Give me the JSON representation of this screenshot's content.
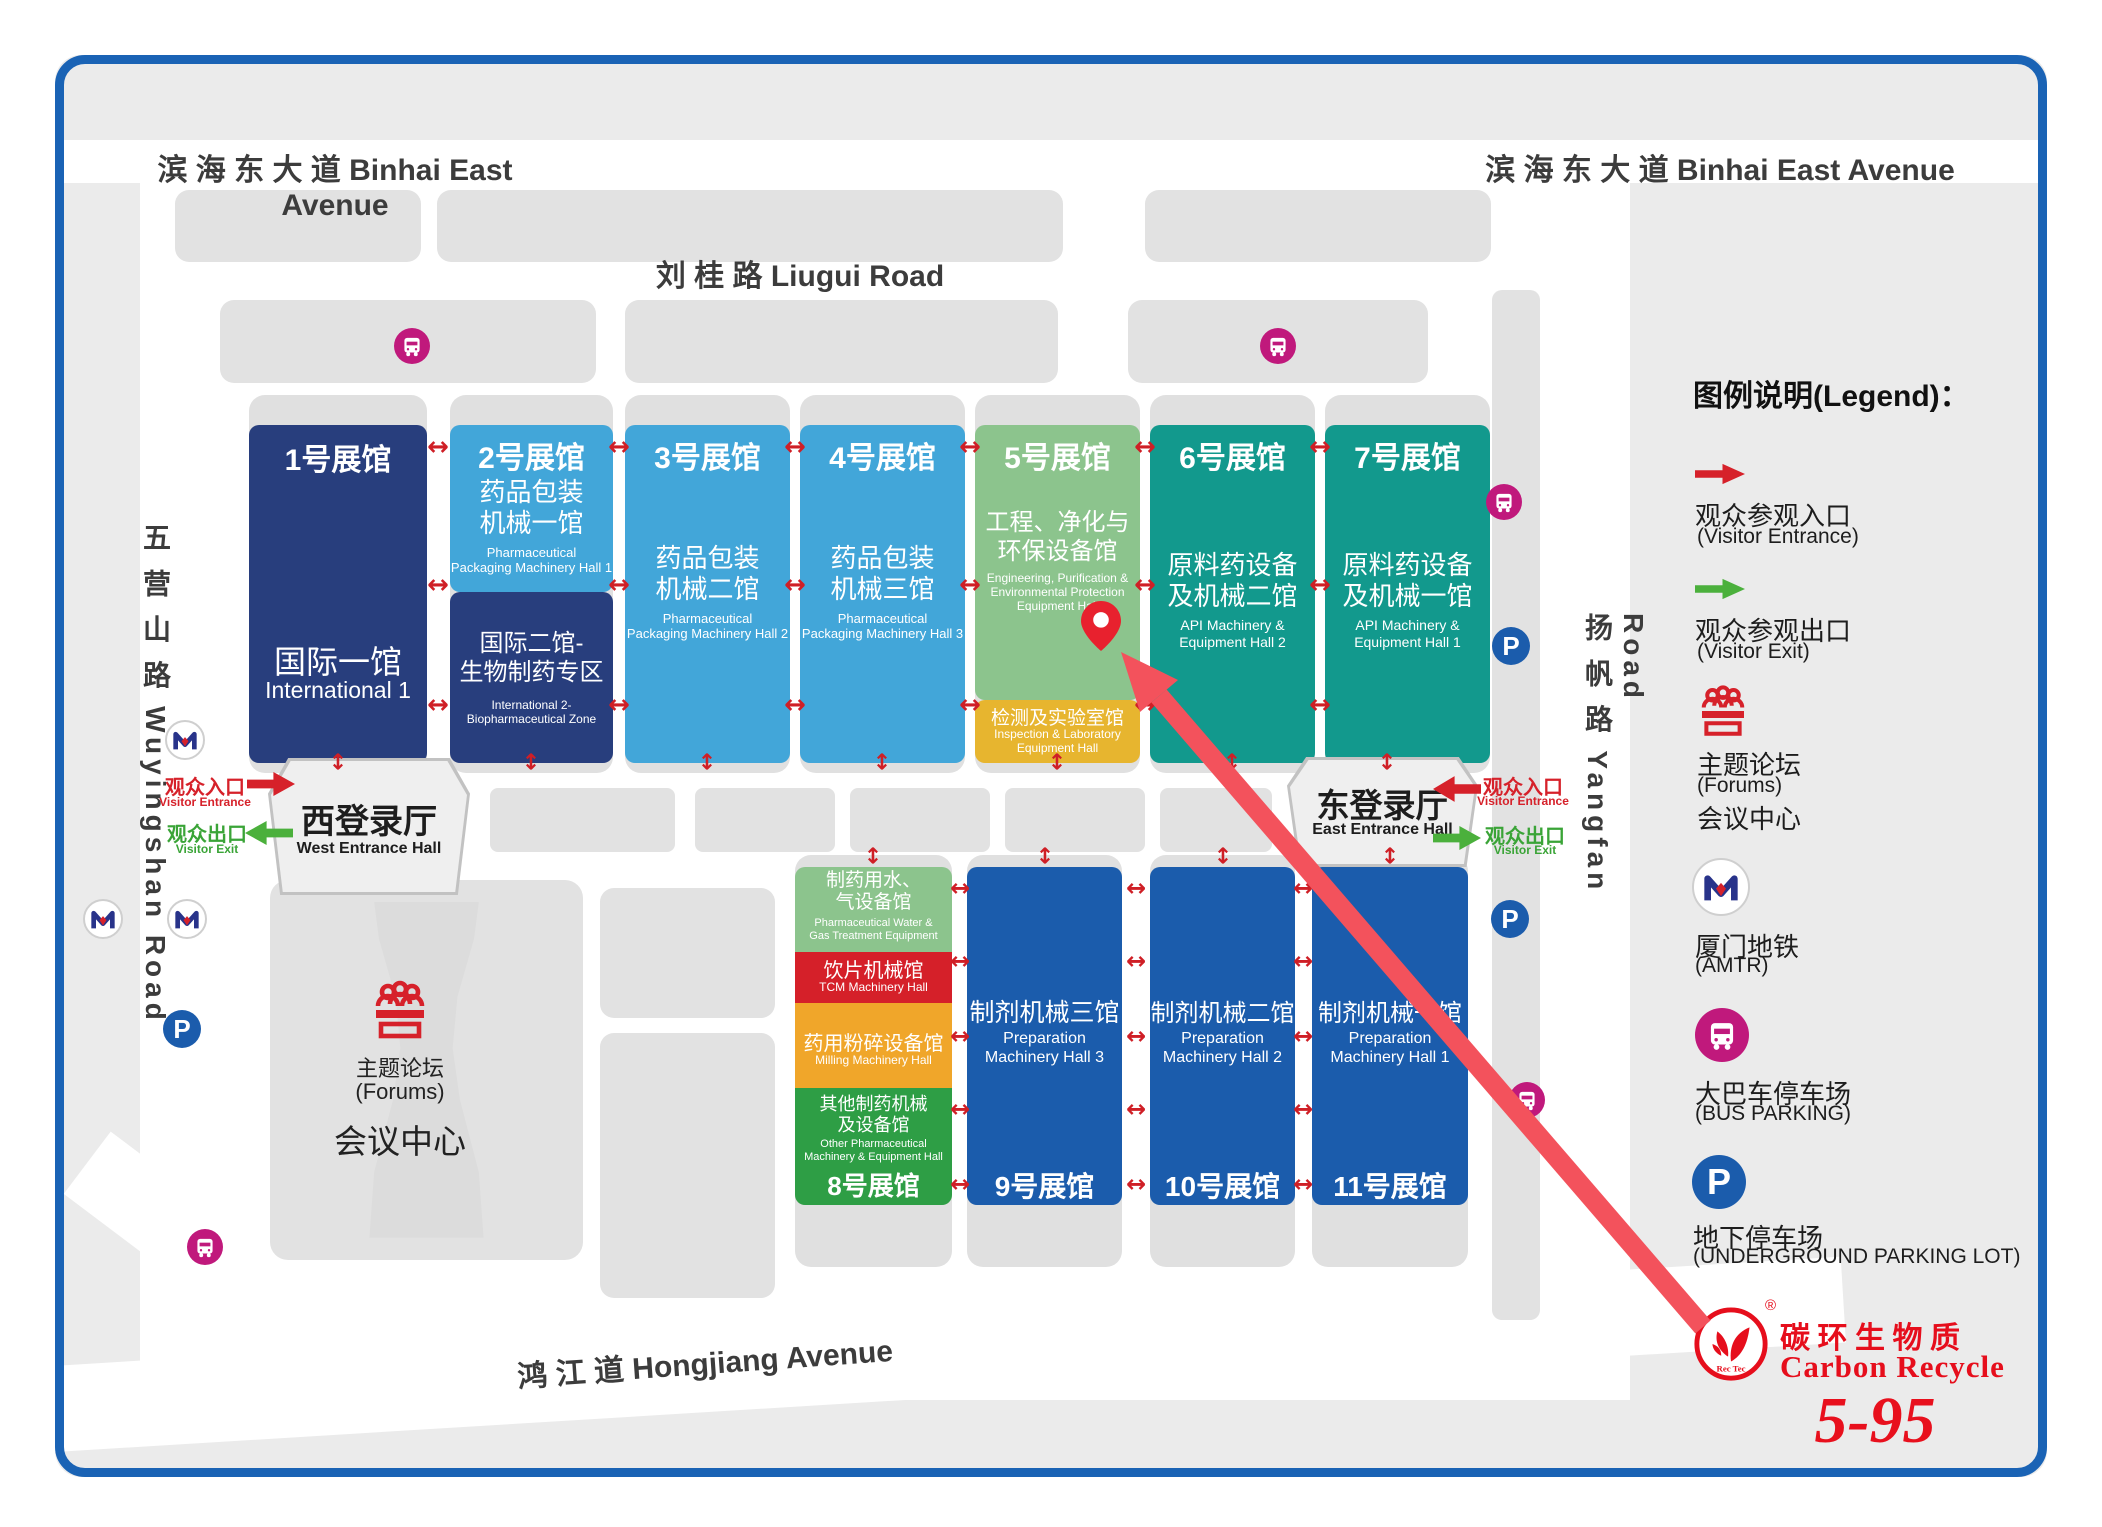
{
  "roads": {
    "binhai": "滨 海 东 大 道  Binhai East Avenue",
    "liugui": "刘 桂 路   Liugui Road",
    "hongjiang": "鸿 江 道  Hongjiang Avenue",
    "wuyingshan": "五 营 山 路 Wuyingshan Road",
    "yangfan": "扬 帆 路 Yangfan Road"
  },
  "halls": {
    "h1": {
      "no": "1号展馆",
      "cn": "国际一馆",
      "en": "International 1"
    },
    "h2": {
      "no": "2号展馆",
      "cn": "药品包装\n机械一馆",
      "en": "Pharmaceutical\nPackaging Machinery Hall 1"
    },
    "h2b": {
      "cn": "国际二馆-\n生物制药专区",
      "en": "International 2-\nBiopharmaceutical Zone"
    },
    "h3": {
      "no": "3号展馆",
      "cn": "药品包装\n机械二馆",
      "en": "Pharmaceutical\nPackaging Machinery Hall 2"
    },
    "h4": {
      "no": "4号展馆",
      "cn": "药品包装\n机械三馆",
      "en": "Pharmaceutical\nPackaging Machinery Hall 3"
    },
    "h5": {
      "no": "5号展馆",
      "cn": "工程、净化与\n环保设备馆",
      "en": "Engineering, Purification &\nEnvironmental Protection\nEquipment Hall"
    },
    "h5b": {
      "cn": "检测及实验室馆",
      "en": "Inspection & Laboratory\nEquipment Hall"
    },
    "h6": {
      "no": "6号展馆",
      "cn": "原料药设备\n及机械二馆",
      "en": "API Machinery &\nEquipment Hall 2"
    },
    "h7": {
      "no": "7号展馆",
      "cn": "原料药设备\n及机械一馆",
      "en": "API Machinery &\nEquipment Hall 1"
    },
    "h8a": {
      "cn": "制药用水、\n气设备馆",
      "en": "Pharmaceutical Water &\nGas Treatment Equipment"
    },
    "h8b": {
      "cn": "饮片机械馆",
      "en": "TCM Machinery Hall"
    },
    "h8c": {
      "cn": "药用粉碎设备馆",
      "en": "Milling Machinery Hall"
    },
    "h8d": {
      "no": "8号展馆",
      "cn": "其他制药机械\n及设备馆",
      "en": "Other Pharmaceutical\nMachinery & Equipment Hall"
    },
    "h9": {
      "no": "9号展馆",
      "cn": "制剂机械三馆",
      "en": "Preparation\nMachinery Hall 3"
    },
    "h10": {
      "no": "10号展馆",
      "cn": "制剂机械二馆",
      "en": "Preparation\nMachinery Hall 2"
    },
    "h11": {
      "no": "11号展馆",
      "cn": "制剂机械一馆",
      "en": "Preparation\nMachinery Hall 1"
    }
  },
  "conference": {
    "cn": "主题论坛",
    "en": "(Forums)",
    "cn2": "会议中心"
  },
  "entrances": {
    "west": {
      "cn": "西登录厅",
      "en": "West Entrance Hall"
    },
    "east": {
      "cn": "东登录厅",
      "en": "East Entrance Hall"
    },
    "entrance_cn": "观众入口",
    "entrance_en": "Visitor Entrance",
    "exit_cn": "观众出口",
    "exit_en": "Visitor Exit"
  },
  "legend": {
    "title": "图例说明(Legend)：",
    "entrance_cn": "观众参观入口",
    "entrance_en": "(Visitor Entrance)",
    "exit_cn": "观众参观出口",
    "exit_en": "(Visitor Exit)",
    "forums_cn": "主题论坛",
    "forums_en": "(Forums)",
    "forums_cn2": "会议中心",
    "metro_cn": "厦门地铁",
    "metro_en": "(AMTR)",
    "bus_cn": "大巴车停车场",
    "bus_en": "(BUS PARKING)",
    "parking_cn": "地下停车场",
    "parking_en": "(UNDERGROUND PARKING LOT)"
  },
  "exhibitor": {
    "logo_cn": "碳 环 生 物 质",
    "logo_en": "Carbon Recycle",
    "logo_mark": "Rec Tec",
    "reg": "®",
    "booth": "5-95"
  },
  "colors": {
    "frame": "#1a63b5",
    "navy": "#283e7d",
    "lightblue": "#42a6d9",
    "green_light": "#8cc48d",
    "teal": "#12998d",
    "yellow": "#e7b52f",
    "blue": "#1b5cac",
    "red_block": "#d52029",
    "orange": "#f0a62a",
    "green": "#2e9e45",
    "arrow_red": "#d6212a",
    "arrow_green": "#4bb03c",
    "bus": "#c0197c",
    "parking": "#1b5cac",
    "pin": "#e8212e",
    "route": "#f3525c",
    "brand_red": "#e60e1c"
  }
}
